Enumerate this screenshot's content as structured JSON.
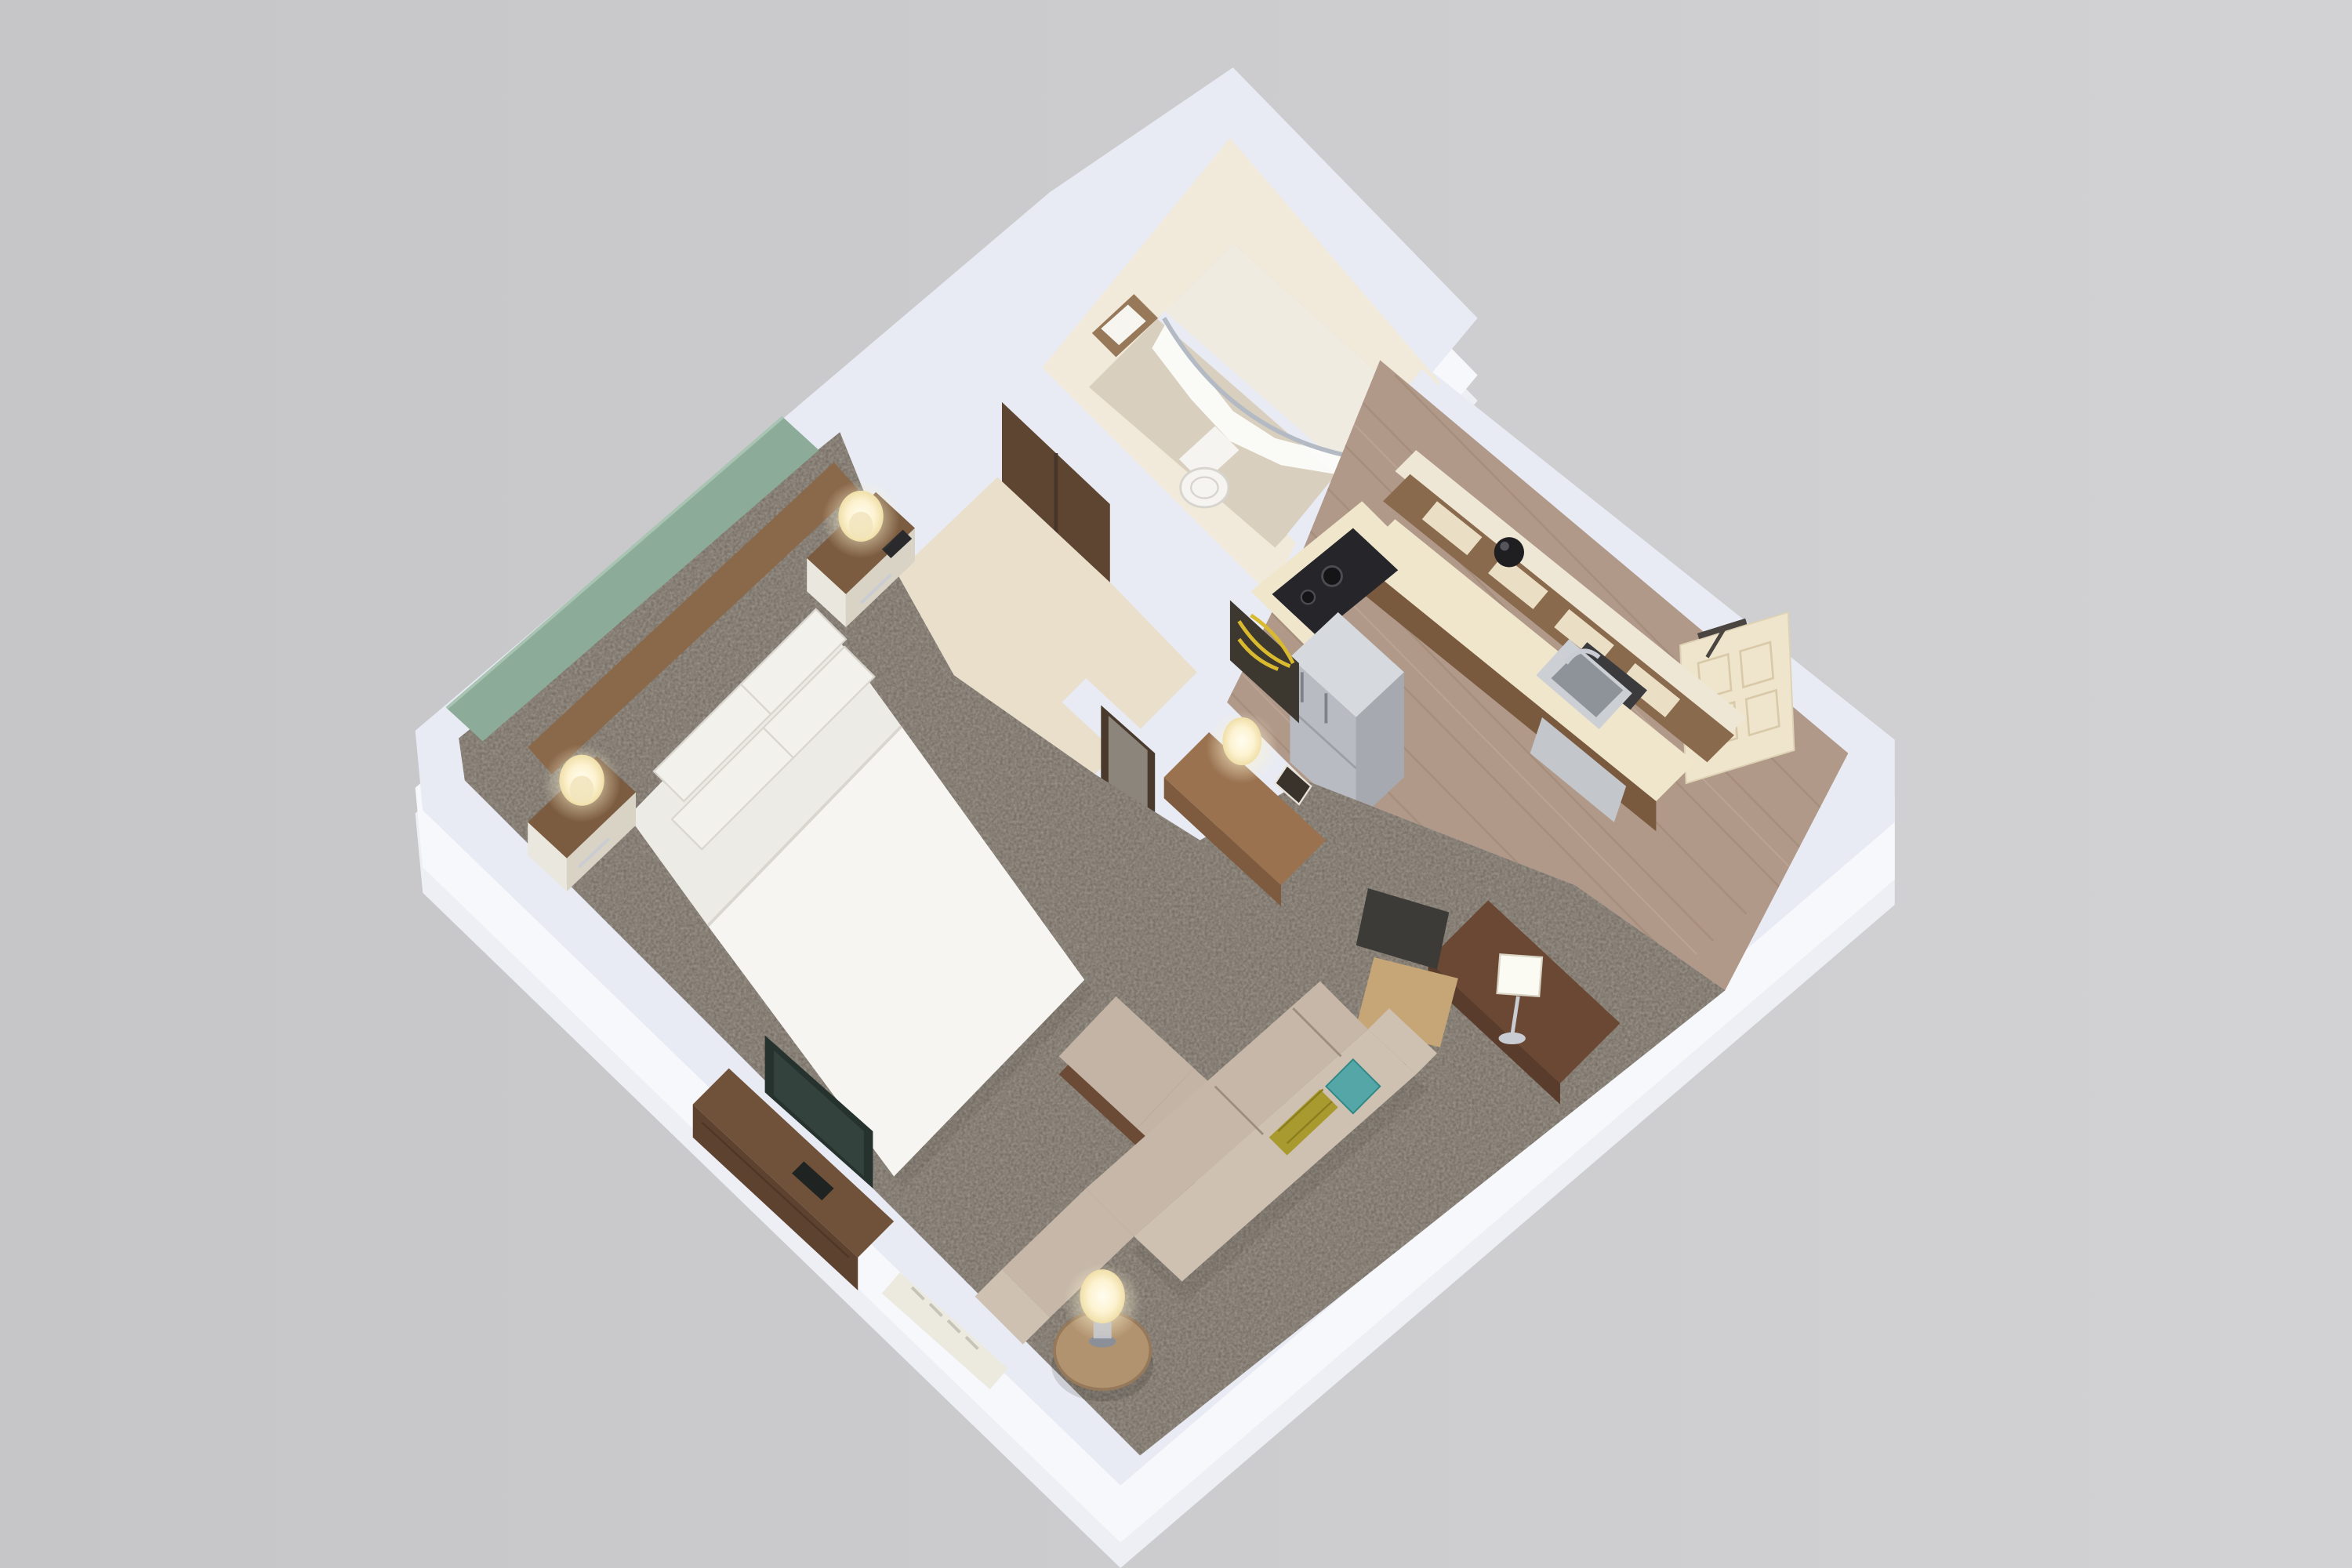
{
  "scene": {
    "type": "isometric-3d-floor-plan",
    "description": "Top-down 3D cutaway rendering of a hotel studio suite",
    "rooms": [
      "bedroom",
      "bathroom",
      "closet",
      "hallway",
      "kitchenette",
      "entry",
      "living-area"
    ]
  },
  "colors": {
    "bg": "#c6c6c8",
    "bg_right": "#d2d2d4",
    "wall_top": "#e8ebf3",
    "wall_outer": "#f7f8fc",
    "wall_ground": "#edeff5",
    "cream_wall": "#f1e9d9",
    "soffit": "#efe7d6",
    "bath_floor": "#d9cfbe",
    "shower_floor": "#f0ebe1",
    "curtain": "#fbfbf9",
    "rod": "#b4bac4",
    "towel_shelf": "#97795a",
    "towel": "#f7f5f0",
    "toilet": "#f5f4f1",
    "toilet_shadow": "#d7d4ce",
    "closet_door": "#5d4532",
    "closet_door_dark": "#49362a",
    "hall_floor": "#e9dfcb",
    "wood_floor": "#b1998a",
    "wood_line": "#9f8776",
    "wood_line_light": "#c6af9d",
    "carpet": "#6e665c",
    "carpet_speck": "#8a8173",
    "green_wall": "#8cab99",
    "green_wall_light": "#a9c4b2",
    "headboard": "#8a684a",
    "cabinet_wood": "#8a6a4c",
    "cabinet_panel": "#eadfc5",
    "counter": "#efe6cb",
    "counter_edge": "#7a5a3e",
    "cooktop": "#26262a",
    "sink_outer": "#ccd0d5",
    "sink_inner": "#8e939a",
    "fridge_top": "#d6d9dd",
    "fridge_front": "#b8bcc2",
    "fridge_side": "#a6aab0",
    "dishwasher": "#c3c7cc",
    "appliance_dark": "#1f1f22",
    "door_cream": "#efe5cd",
    "door_line": "#d8c9a8",
    "door_hw": "#4a4540",
    "mirror_frame": "#4a3a2e",
    "mirror_glass": "#8b857c",
    "art_dark": "#3c3830",
    "art_yellow": "#d9ba2f",
    "console_wood": "#9a7250",
    "console_front": "#7e5b3e",
    "desk": "#6b4834",
    "desk_dark": "#593c2b",
    "chair_seat": "#c6a676",
    "chair_back": "#3c3b38",
    "sofa_seat": "#c6b7a8",
    "sofa_back": "#cfc1b2",
    "sofa_shadow": "#9c8d80",
    "pillow_teal": "#54a7a6",
    "pillow_chartreuse": "#a89a2e",
    "ottoman_cushion": "#c3b4a5",
    "ottoman_base": "#6b4b35",
    "side_table": "#b2936f",
    "bed_sheet": "#ecebe5",
    "bed_duvet": "#f6f5f2",
    "pillow": "#f3f1ec",
    "pillow_shade": "#d9d6cf",
    "nightstand_wood": "#7c5c40",
    "drawer_front": "#eae7df",
    "drawer_side": "#d9d3c6",
    "remote": "#2a2a2c",
    "dresser": "#70523a",
    "dresser_front": "#5e4230",
    "tv": "#26322e",
    "tv_screen": "#41524b",
    "heater": "#eceadf",
    "heater_slot": "#c6c4b8",
    "chrome": "#c9ccd2",
    "lamp_core": "#fffdf0",
    "lamp_mid": "#fdf3d2",
    "lamp_edge": "#f0dfa8"
  }
}
